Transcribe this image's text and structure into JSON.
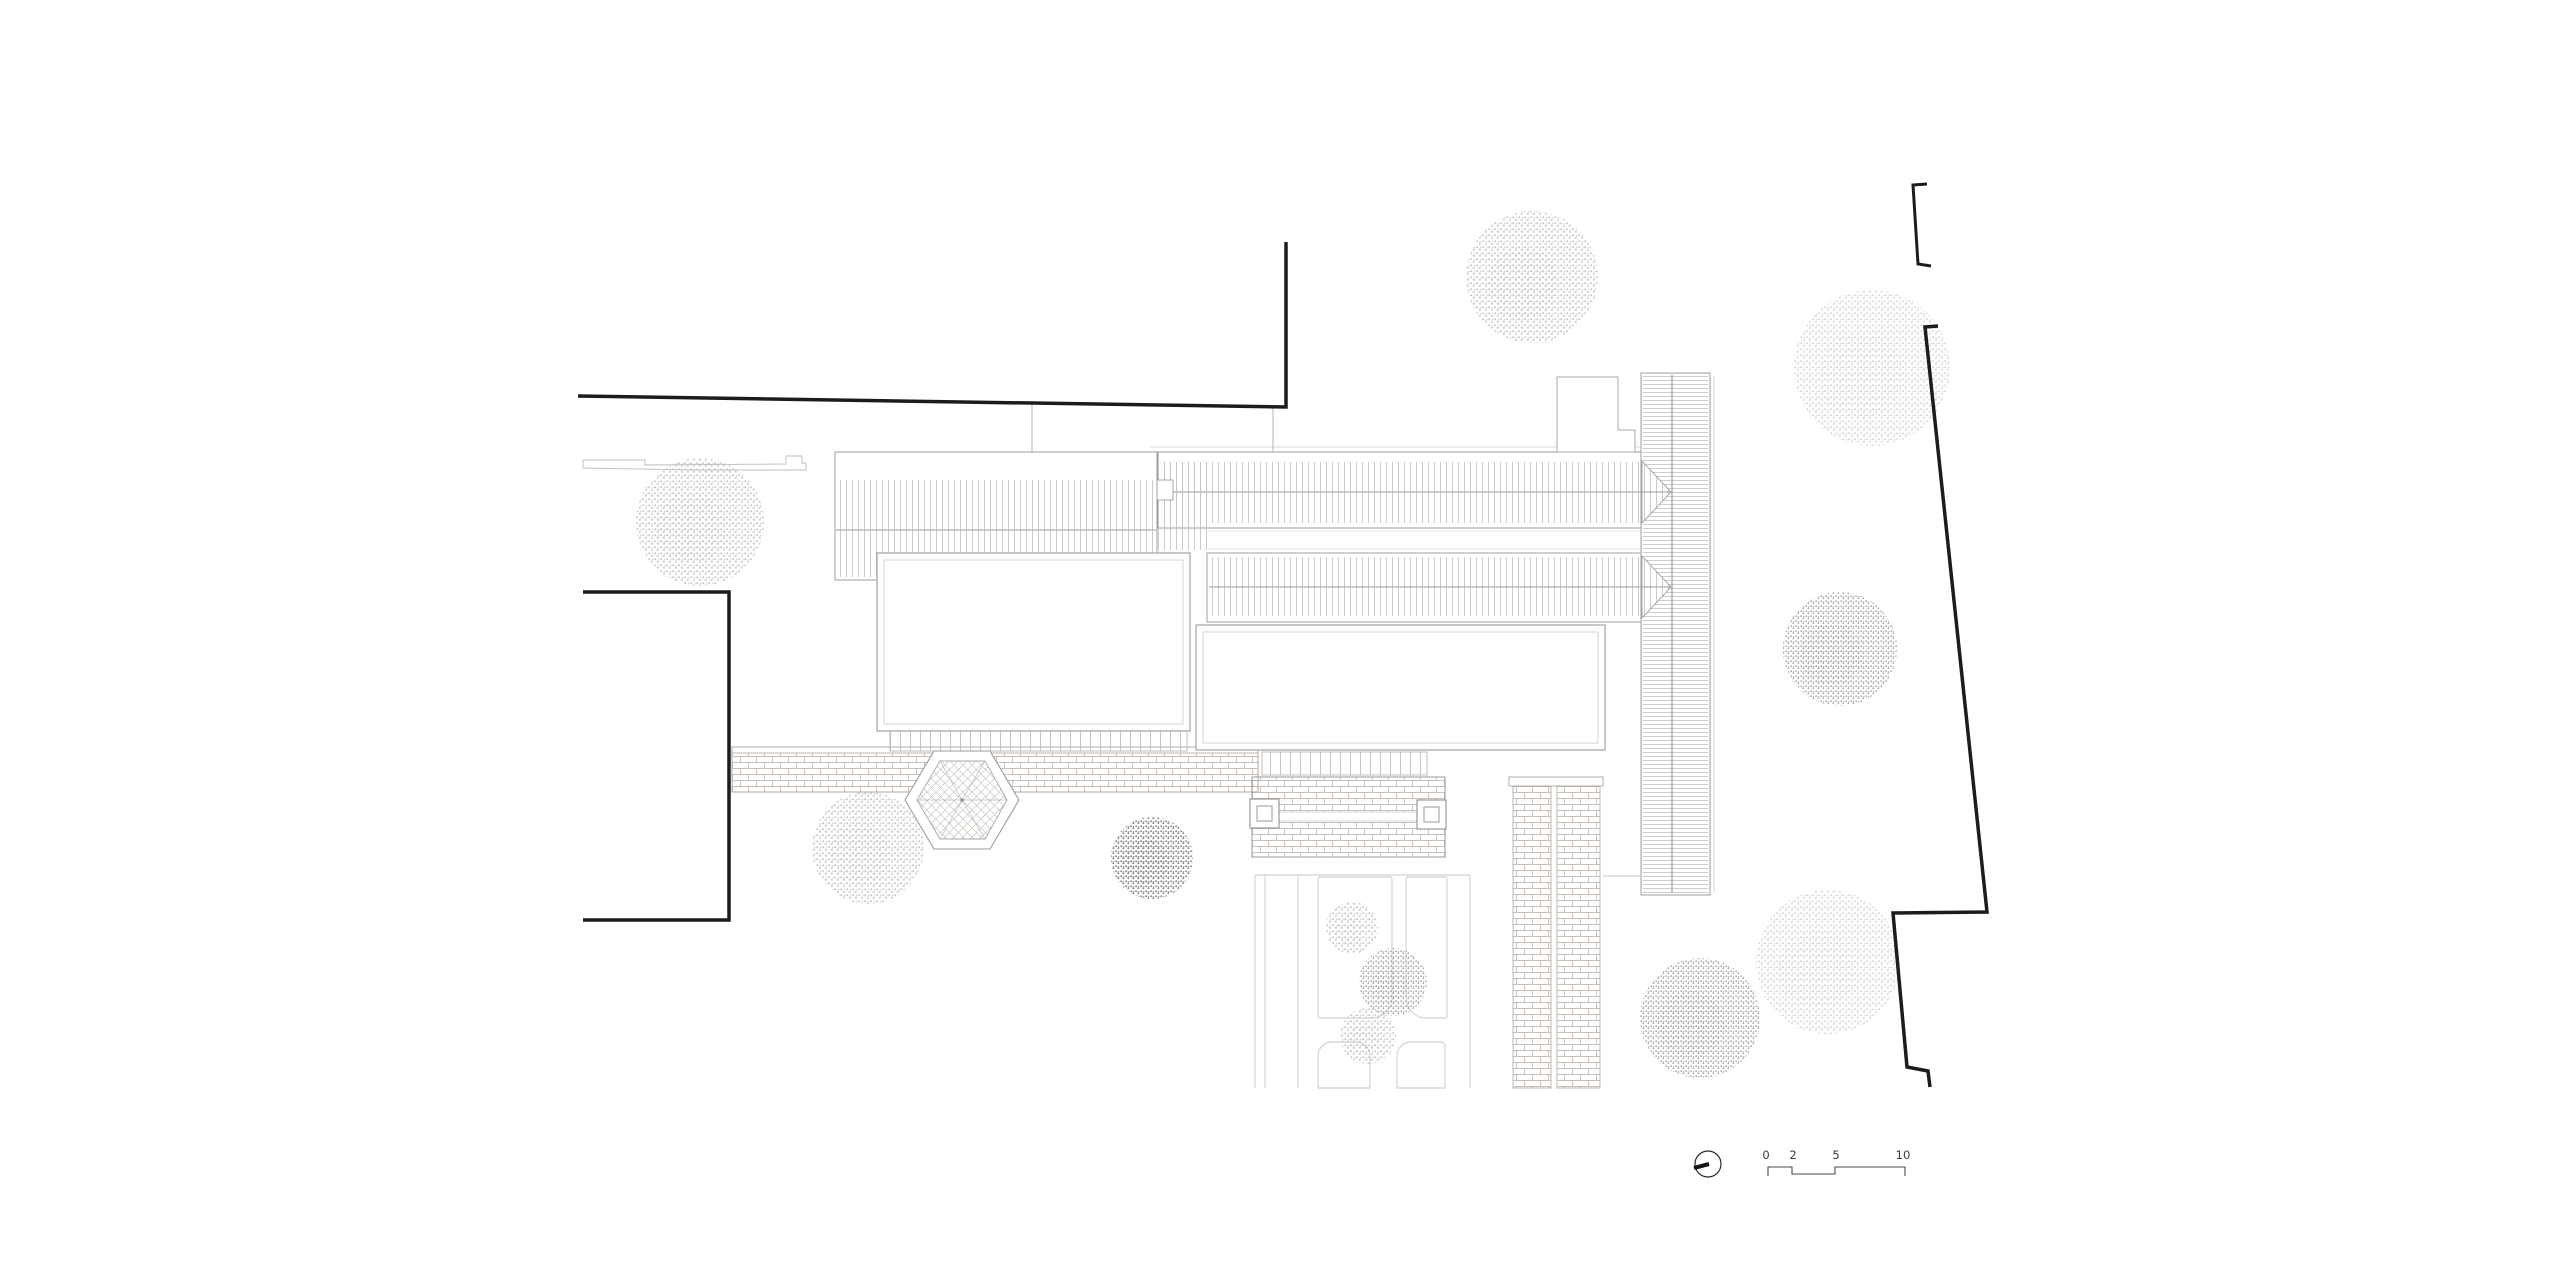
{
  "title": "Architectural site plan — courtyard hall complex with garden, roof plan",
  "canvas": {
    "width": 2560,
    "height": 1280,
    "background": "#ffffff"
  },
  "palette": {
    "paper": "#ffffff",
    "boundary_line": "#1c1c1c",
    "building_outline": "#9e9e9e",
    "light_outline": "#c6c6c6",
    "roof_hatch": "#c0c0c0",
    "brick_line": "#b6aba2",
    "tree_light": "#c7c7c7",
    "tree_dark": "#909090",
    "annotation_text": "#3c3c3c"
  },
  "patterns": [
    {
      "id": "vhatch",
      "type": "vlines",
      "w": 6,
      "h": 10,
      "stroke": "#c0c0c0",
      "sw": 0.8
    },
    {
      "id": "hhatch",
      "type": "hlines",
      "w": 10,
      "h": 4,
      "stroke": "#bfbfbf",
      "sw": 0.8
    },
    {
      "id": "brick",
      "type": "brick",
      "w": 16,
      "h": 12,
      "stroke": "#b6aba2",
      "sw": 0.7
    },
    {
      "id": "diamond",
      "type": "diamond",
      "w": 9,
      "h": 9,
      "stroke": "#c3bab2",
      "sw": 0.6
    },
    {
      "id": "ticks",
      "type": "vlines",
      "w": 10,
      "h": 30,
      "stroke": "#b8b8b8",
      "sw": 0.8
    },
    {
      "id": "t-xlight",
      "type": "stipple",
      "w": 6,
      "h": 6,
      "stroke": "#d6d6d6",
      "dr": 1.0
    },
    {
      "id": "t-light",
      "type": "stipple",
      "w": 6,
      "h": 6,
      "stroke": "#c7c7c7",
      "dr": 1.0
    },
    {
      "id": "t-med",
      "type": "stipple",
      "w": 5,
      "h": 5,
      "stroke": "#ababab",
      "dr": 0.9
    },
    {
      "id": "t-dark",
      "type": "stipple",
      "w": 5,
      "h": 5,
      "stroke": "#909090",
      "dr": 1.0
    }
  ],
  "scale_bar": {
    "labels": [
      "0",
      "2",
      "5",
      "10"
    ],
    "positions": [
      1766,
      1793,
      1836,
      1903
    ],
    "baseline_y": 1159,
    "path": "M1768,1176 L1768,1167 L1792,1167 L1792,1174 L1835,1174 L1835,1167 L1905,1167 L1905,1176",
    "font_size": 11.5,
    "color": "#3c3c3c",
    "line_color": "#4a4a4a"
  },
  "north_arrow": {
    "cx": 1708,
    "cy": 1164,
    "r": 13,
    "needle": [
      1694,
      1168,
      1709,
      1164
    ],
    "ring_color": "#2a2a2a",
    "needle_color": "#151515"
  },
  "elements": [
    {
      "t": "rect",
      "n": "main-path-border",
      "x": 732,
      "y": 747,
      "w": 526,
      "h": 45,
      "f": "#ffffff",
      "s": "#ababab",
      "sw": 1
    },
    {
      "t": "rect",
      "n": "main-path-paving",
      "x": 732,
      "y": 753,
      "w": 526,
      "h": 39,
      "f": "@brick",
      "s": "#b0a79e",
      "sw": 0.8
    },
    {
      "t": "rect",
      "n": "colonnade-north",
      "x": 890,
      "y": 730,
      "w": 297,
      "h": 21,
      "f": "@ticks",
      "s": "#b5b5b5",
      "sw": 0.9
    },
    {
      "t": "rect",
      "n": "colonnade-east",
      "x": 1262,
      "y": 752,
      "w": 165,
      "h": 23,
      "f": "@ticks",
      "s": "#b5b5b5",
      "sw": 0.9
    },
    {
      "t": "line",
      "n": "garden-edge-line",
      "x1": 1255,
      "y1": 875,
      "x2": 1470,
      "y2": 875,
      "s": "#c6c6c6",
      "sw": 0.9
    },
    {
      "t": "line",
      "n": "garden-path-line",
      "x1": 1255,
      "y1": 875,
      "x2": 1255,
      "y2": 1088,
      "s": "#c6c6c6",
      "sw": 0.9
    },
    {
      "t": "line",
      "n": "garden-path-line",
      "x1": 1265,
      "y1": 875,
      "x2": 1265,
      "y2": 1088,
      "s": "#c6c6c6",
      "sw": 0.9
    },
    {
      "t": "line",
      "n": "garden-path-line",
      "x1": 1298,
      "y1": 875,
      "x2": 1298,
      "y2": 1088,
      "s": "#c6c6c6",
      "sw": 0.9
    },
    {
      "t": "line",
      "n": "garden-path-line",
      "x1": 1470,
      "y1": 875,
      "x2": 1470,
      "y2": 1088,
      "s": "#c6c6c6",
      "sw": 0.9
    },
    {
      "t": "rrect",
      "n": "garden-bed",
      "x": 1318,
      "y": 877,
      "w": 74,
      "h": 141,
      "r": [
        2,
        2,
        20,
        2
      ],
      "f": "#ffffff",
      "s": "#c6c6c6",
      "sw": 0.9
    },
    {
      "t": "rrect",
      "n": "garden-bed",
      "x": 1406,
      "y": 877,
      "w": 41,
      "h": 141,
      "r": [
        2,
        2,
        2,
        20
      ],
      "f": "#ffffff",
      "s": "#c6c6c6",
      "sw": 0.9
    },
    {
      "t": "rrect",
      "n": "garden-bed",
      "x": 1318,
      "y": 1042,
      "w": 52,
      "h": 46,
      "r": [
        14,
        14,
        0,
        0
      ],
      "f": "#ffffff",
      "s": "#c6c6c6",
      "sw": 0.9
    },
    {
      "t": "rrect",
      "n": "garden-bed",
      "x": 1397,
      "y": 1042,
      "w": 48,
      "h": 46,
      "r": [
        14,
        4,
        0,
        0
      ],
      "f": "#ffffff",
      "s": "#c6c6c6",
      "sw": 0.9
    },
    {
      "t": "rect",
      "n": "brick-walk-head",
      "x": 1509,
      "y": 777,
      "w": 94,
      "h": 9,
      "f": "#ffffff",
      "s": "#a8a8a8",
      "sw": 0.9
    },
    {
      "t": "rect",
      "n": "brick-walk-west",
      "x": 1513,
      "y": 786,
      "w": 38,
      "h": 302,
      "f": "@brick",
      "s": "#b0a79e",
      "sw": 0.8
    },
    {
      "t": "rect",
      "n": "brick-walk-east",
      "x": 1557,
      "y": 786,
      "w": 43,
      "h": 302,
      "f": "@brick",
      "s": "#b0a79e",
      "sw": 0.8
    },
    {
      "t": "line",
      "n": "ground-line",
      "x1": 1603,
      "y1": 876,
      "x2": 1641,
      "y2": 876,
      "s": "#c6c6c6",
      "sw": 0.9
    },
    {
      "t": "rect",
      "n": "hall-west-roof",
      "x": 835,
      "y": 452,
      "w": 322,
      "h": 128,
      "f": "#ffffff",
      "s": "#9e9e9e",
      "sw": 1
    },
    {
      "t": "rect",
      "n": "hall-west-roof-north-slope",
      "x": 837,
      "y": 480,
      "w": 318,
      "h": 50,
      "f": "@vhatch",
      "s": "none"
    },
    {
      "t": "line",
      "n": "ridge-line",
      "x1": 836,
      "y1": 530,
      "x2": 1156,
      "y2": 530,
      "s": "#9a9a9a",
      "sw": 1.1
    },
    {
      "t": "rect",
      "n": "hall-west-roof-south-slope",
      "x": 837,
      "y": 530,
      "w": 318,
      "h": 47,
      "f": "@vhatch",
      "s": "none"
    },
    {
      "t": "line",
      "n": "eave-line",
      "x1": 1150,
      "y1": 447,
      "x2": 1642,
      "y2": 447,
      "s": "#cccccc",
      "sw": 0.8
    },
    {
      "t": "rect",
      "n": "hall-north-roof",
      "x": 1158,
      "y": 452,
      "w": 484,
      "h": 76,
      "f": "#ffffff",
      "s": "#9e9e9e",
      "sw": 1
    },
    {
      "t": "rect",
      "n": "hall-north-roof-north-slope",
      "x": 1160,
      "y": 462,
      "w": 481,
      "h": 30,
      "f": "@vhatch",
      "s": "none"
    },
    {
      "t": "line",
      "n": "ridge-line",
      "x1": 1160,
      "y1": 492,
      "x2": 1642,
      "y2": 492,
      "s": "#9a9a9a",
      "sw": 1.1
    },
    {
      "t": "rect",
      "n": "hall-north-roof-south-slope",
      "x": 1160,
      "y": 492,
      "w": 481,
      "h": 31,
      "f": "@vhatch",
      "s": "none"
    },
    {
      "t": "rect",
      "n": "roof-connector",
      "x": 1157,
      "y": 462,
      "w": 50,
      "h": 88,
      "f": "@vhatch",
      "s": "none"
    },
    {
      "t": "rect",
      "n": "chimney",
      "x": 1157,
      "y": 480,
      "w": 16,
      "h": 20,
      "f": "#ffffff",
      "s": "#9e9e9e",
      "sw": 0.9
    },
    {
      "t": "line",
      "n": "court-line",
      "x1": 1209,
      "y1": 531,
      "x2": 1640,
      "y2": 531,
      "s": "#dadada",
      "sw": 0.8
    },
    {
      "t": "line",
      "n": "court-line",
      "x1": 1209,
      "y1": 549,
      "x2": 1640,
      "y2": 549,
      "s": "#dadada",
      "sw": 0.8
    },
    {
      "t": "rect",
      "n": "courtyard-west",
      "x": 877,
      "y": 553,
      "w": 313,
      "h": 178,
      "f": "#ffffff",
      "s": "#9a9a9a",
      "sw": 1.1
    },
    {
      "t": "rect",
      "n": "courtyard-west-inner",
      "x": 884,
      "y": 560,
      "w": 299,
      "h": 164,
      "f": "none",
      "s": "#d0d0d0",
      "sw": 0.9
    },
    {
      "t": "rect",
      "n": "hall-south-roof",
      "x": 1207,
      "y": 553,
      "w": 435,
      "h": 69,
      "f": "#ffffff",
      "s": "#9e9e9e",
      "sw": 1
    },
    {
      "t": "rect",
      "n": "hall-south-roof-north-slope",
      "x": 1209,
      "y": 557,
      "w": 432,
      "h": 30,
      "f": "@vhatch",
      "s": "none"
    },
    {
      "t": "line",
      "n": "ridge-line",
      "x1": 1209,
      "y1": 587,
      "x2": 1642,
      "y2": 587,
      "s": "#9a9a9a",
      "sw": 1.1
    },
    {
      "t": "rect",
      "n": "hall-south-roof-south-slope",
      "x": 1209,
      "y": 587,
      "w": 432,
      "h": 29,
      "f": "@vhatch",
      "s": "none"
    },
    {
      "t": "rect",
      "n": "courtyard-east",
      "x": 1196,
      "y": 625,
      "w": 409,
      "h": 125,
      "f": "#ffffff",
      "s": "#9a9a9a",
      "sw": 1.1
    },
    {
      "t": "rect",
      "n": "courtyard-east-inner",
      "x": 1203,
      "y": 632,
      "w": 395,
      "h": 111,
      "f": "none",
      "s": "#d0d0d0",
      "sw": 0.9
    },
    {
      "t": "rect",
      "n": "gallery-roof",
      "x": 1641,
      "y": 373,
      "w": 69,
      "h": 522,
      "f": "#ffffff",
      "s": "#9e9e9e",
      "sw": 1
    },
    {
      "t": "rect",
      "n": "gallery-roof-hatch",
      "x": 1643,
      "y": 375,
      "w": 65,
      "h": 518,
      "f": "@hhatch",
      "s": "none"
    },
    {
      "t": "line",
      "n": "gallery-ridge",
      "x1": 1672,
      "y1": 375,
      "x2": 1672,
      "y2": 893,
      "s": "#9a9a9a",
      "sw": 1.1
    },
    {
      "t": "line",
      "n": "gallery-eave-line",
      "x1": 1714,
      "y1": 376,
      "x2": 1714,
      "y2": 893,
      "s": "#cccccc",
      "sw": 0.8
    },
    {
      "t": "poly",
      "n": "hip-end-base",
      "pts": [
        [
          1642,
          461
        ],
        [
          1671,
          492
        ],
        [
          1642,
          523
        ]
      ],
      "f": "#ffffff",
      "s": "none"
    },
    {
      "t": "poly",
      "n": "hip-end",
      "pts": [
        [
          1642,
          461
        ],
        [
          1671,
          492
        ],
        [
          1642,
          523
        ]
      ],
      "f": "@vhatch",
      "s": "#9e9e9e",
      "sw": 0.9
    },
    {
      "t": "line",
      "n": "hip-ridge",
      "x1": 1642,
      "y1": 492,
      "x2": 1671,
      "y2": 492,
      "s": "#9a9a9a",
      "sw": 1
    },
    {
      "t": "poly",
      "n": "hip-end-base",
      "pts": [
        [
          1642,
          556
        ],
        [
          1671,
          587
        ],
        [
          1642,
          618
        ]
      ],
      "f": "#ffffff",
      "s": "none"
    },
    {
      "t": "poly",
      "n": "hip-end",
      "pts": [
        [
          1642,
          556
        ],
        [
          1671,
          587
        ],
        [
          1642,
          618
        ]
      ],
      "f": "@vhatch",
      "s": "#9e9e9e",
      "sw": 0.9
    },
    {
      "t": "line",
      "n": "hip-ridge",
      "x1": 1642,
      "y1": 587,
      "x2": 1671,
      "y2": 587,
      "s": "#9a9a9a",
      "sw": 1
    },
    {
      "t": "poly",
      "n": "annex-building",
      "pts": [
        [
          1557,
          377
        ],
        [
          1618,
          377
        ],
        [
          1618,
          430
        ],
        [
          1635,
          430
        ],
        [
          1635,
          452
        ],
        [
          1557,
          452
        ]
      ],
      "f": "#ffffff",
      "s": "#a8a8a8",
      "sw": 1
    },
    {
      "t": "path",
      "n": "retaining-wall",
      "d": "M583,460 L645,460 L645,465 L786,464 L786,456 L802,456 L802,463 L806,463",
      "f": "none",
      "s": "#bdbdbd",
      "sw": 0.9
    },
    {
      "t": "path",
      "n": "retaining-wall",
      "d": "M583,460 L583,468 L700,470 L806,470 L806,463",
      "f": "none",
      "s": "#bdbdbd",
      "sw": 0.9
    },
    {
      "t": "line",
      "n": "wall-tie-line",
      "x1": 1032,
      "y1": 402,
      "x2": 1032,
      "y2": 452,
      "s": "#b5b5b5",
      "sw": 1
    },
    {
      "t": "line",
      "n": "wall-tie-line",
      "x1": 1273,
      "y1": 408,
      "x2": 1273,
      "y2": 452,
      "s": "#b5b5b5",
      "sw": 1
    },
    {
      "t": "poly",
      "n": "pavilion-outer",
      "pts": [
        [
          1019,
          800
        ],
        [
          990,
          849
        ],
        [
          934,
          849
        ],
        [
          905,
          800
        ],
        [
          934,
          751
        ],
        [
          990,
          751
        ]
      ],
      "f": "#ffffff",
      "s": "#9c9c9c",
      "sw": 1.1
    },
    {
      "t": "poly",
      "n": "pavilion-floor",
      "pts": [
        [
          1007,
          800
        ],
        [
          985,
          839
        ],
        [
          940,
          839
        ],
        [
          917,
          800
        ],
        [
          940,
          761
        ],
        [
          985,
          761
        ]
      ],
      "f": "@diamond",
      "s": "#a8a8a8",
      "sw": 0.9
    },
    {
      "t": "path",
      "n": "pavilion-rafters",
      "d": "M962,800 L1007,800 M962,800 L985,839 M962,800 L940,839 M962,800 L917,800 M962,800 L940,761 M962,800 L985,761",
      "f": "none",
      "s": "#b8b8b8",
      "sw": 0.7
    },
    {
      "t": "circle",
      "n": "pavilion-finial",
      "cx": 962,
      "cy": 800,
      "r": 1.6,
      "f": "#8a8a8a",
      "s": "none"
    },
    {
      "t": "rect",
      "n": "pergola-bed",
      "x": 1252,
      "y": 777,
      "w": 193,
      "h": 80,
      "f": "@brick",
      "s": "#9a9a9a",
      "sw": 1
    },
    {
      "t": "rect",
      "n": "pergola-walk",
      "x": 1252,
      "y": 812,
      "w": 193,
      "h": 9,
      "f": "#ffffff",
      "s": "#c8c8c8",
      "sw": 0.7
    },
    {
      "t": "rect",
      "n": "gate-pier",
      "x": 1250,
      "y": 799,
      "w": 29,
      "h": 29,
      "f": "#ffffff",
      "s": "#8f8f8f",
      "sw": 1.1
    },
    {
      "t": "rect",
      "n": "gate-pier-inner",
      "x": 1257,
      "y": 806,
      "w": 15,
      "h": 15,
      "f": "none",
      "s": "#8f8f8f",
      "sw": 0.9
    },
    {
      "t": "rect",
      "n": "gate-pier",
      "x": 1417,
      "y": 800,
      "w": 29,
      "h": 29,
      "f": "#ffffff",
      "s": "#8f8f8f",
      "sw": 1.1
    },
    {
      "t": "rect",
      "n": "gate-pier-inner",
      "x": 1424,
      "y": 807,
      "w": 15,
      "h": 15,
      "f": "none",
      "s": "#8f8f8f",
      "sw": 0.9
    },
    {
      "t": "tree",
      "n": "tree",
      "cx": 1532,
      "cy": 277,
      "r": 66,
      "tone": "light"
    },
    {
      "t": "tree",
      "n": "tree",
      "cx": 1872,
      "cy": 368,
      "r": 78,
      "tone": "xlight"
    },
    {
      "t": "tree",
      "n": "tree",
      "cx": 1840,
      "cy": 649,
      "r": 57,
      "tone": "med"
    },
    {
      "t": "tree",
      "n": "tree",
      "cx": 700,
      "cy": 522,
      "r": 64,
      "tone": "light"
    },
    {
      "t": "tree",
      "n": "tree",
      "cx": 868,
      "cy": 848,
      "r": 56,
      "tone": "light"
    },
    {
      "t": "tree",
      "n": "tree",
      "cx": 1152,
      "cy": 858,
      "r": 41,
      "tone": "dark"
    },
    {
      "t": "tree",
      "n": "tree",
      "cx": 1352,
      "cy": 928,
      "r": 26,
      "tone": "light"
    },
    {
      "t": "tree",
      "n": "tree",
      "cx": 1393,
      "cy": 982,
      "r": 34,
      "tone": "med"
    },
    {
      "t": "tree",
      "n": "tree",
      "cx": 1368,
      "cy": 1036,
      "r": 28,
      "tone": "light"
    },
    {
      "t": "tree",
      "n": "tree",
      "cx": 1700,
      "cy": 1018,
      "r": 60,
      "tone": "med"
    },
    {
      "t": "tree",
      "n": "tree",
      "cx": 1828,
      "cy": 962,
      "r": 72,
      "tone": "xlight"
    },
    {
      "t": "path",
      "n": "site-boundary-north",
      "d": "M578,396 L1286,407 L1286,242",
      "f": "none",
      "s": "#1c1c1c",
      "sw": 3.5
    },
    {
      "t": "path",
      "n": "site-boundary-west",
      "d": "M583,592 L729,592 L729,920 L583,920",
      "f": "none",
      "s": "#1c1c1c",
      "sw": 3.5
    },
    {
      "t": "path",
      "n": "site-boundary-northeast",
      "d": "M1927,184 L1913,185 L1918,264 L1931,266",
      "f": "none",
      "s": "#1c1c1c",
      "sw": 3
    },
    {
      "t": "path",
      "n": "site-boundary-east",
      "d": "M1938,326 L1925,327 L1987,912 L1893,913 L1907,1067 L1928,1071 L1930,1087",
      "f": "none",
      "s": "#1c1c1c",
      "sw": 3.5
    }
  ]
}
